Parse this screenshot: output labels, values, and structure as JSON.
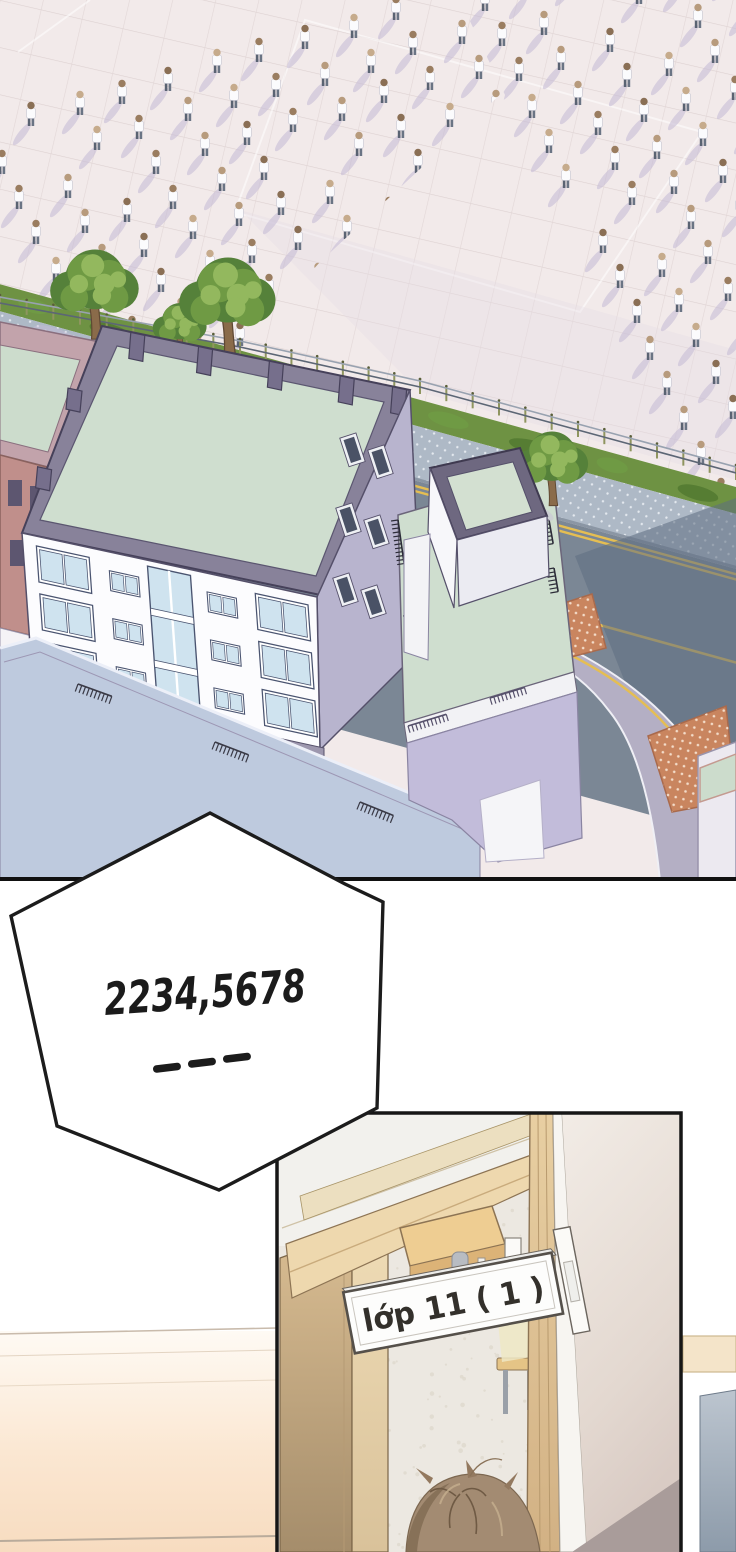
{
  "page": {
    "kind": "webtoon comic page",
    "width": 736,
    "height": 1552
  },
  "speech_bubble": {
    "text": "2234,5678",
    "dashes": "———",
    "dash_count": 3,
    "ink": "#1b1b1b",
    "fill": "#ffffff"
  },
  "door_sign": {
    "text": "lớp 11 ( 1 )",
    "text_color": "#33302b",
    "fill": "#fdfdfc",
    "border": "#55504a"
  },
  "palette": {
    "plaza": "#f2eaea",
    "plaza_grid": "#ddd1d1",
    "figure_shadow": "#c7bcd6",
    "shirt": "#fbfbfd",
    "pants": "#5f6878",
    "head_tones": [
      "#b79b7d",
      "#9a7d60",
      "#c6ab8c",
      "#8a6f55"
    ],
    "tree_dark": "#55813a",
    "tree_mid": "#6f9a44",
    "tree_light": "#93b85e",
    "trunk": "#8a6b4a",
    "roof_frame": "#88829a",
    "roof_inner": "#cfdecf",
    "facade": "#fcfcfe",
    "window_glass": "#cfe3ef",
    "window_frame": "#4a5470",
    "side_face": "#b8b4ce",
    "wing_roof_blue": "#becade",
    "road": "#7b8795",
    "road_shadow": "#5f6d81",
    "sidewalk": "#aeb9c6",
    "grass": "#6e9243",
    "lane_yellow": "#e5be52",
    "crosswalk_red": "#c9855f",
    "panel_border": "#161616",
    "wood_dark": "#cdb287",
    "wood_light": "#ecd8b0",
    "classroom_floor": "#ece8e1",
    "hall_wall_left": "#fbe7d2",
    "hair": "#a38b72",
    "greige_wall": "#e7ddd5",
    "floor_wedge": "#a99c9a",
    "slab_blue": "#9fadbc"
  },
  "scene": {
    "crowd": {
      "u": [
        46,
        -13
      ],
      "v": [
        17,
        35
      ],
      "groups": [
        {
          "name": "left-formation",
          "origin": [
            -15,
            140
          ],
          "cols": 12,
          "rows": 9,
          "clip": "crowdClipL"
        },
        {
          "name": "right-formation",
          "origin": [
            465,
            -25
          ],
          "cols": 8,
          "rows": 16,
          "clip": "crowdClipR"
        }
      ]
    }
  }
}
